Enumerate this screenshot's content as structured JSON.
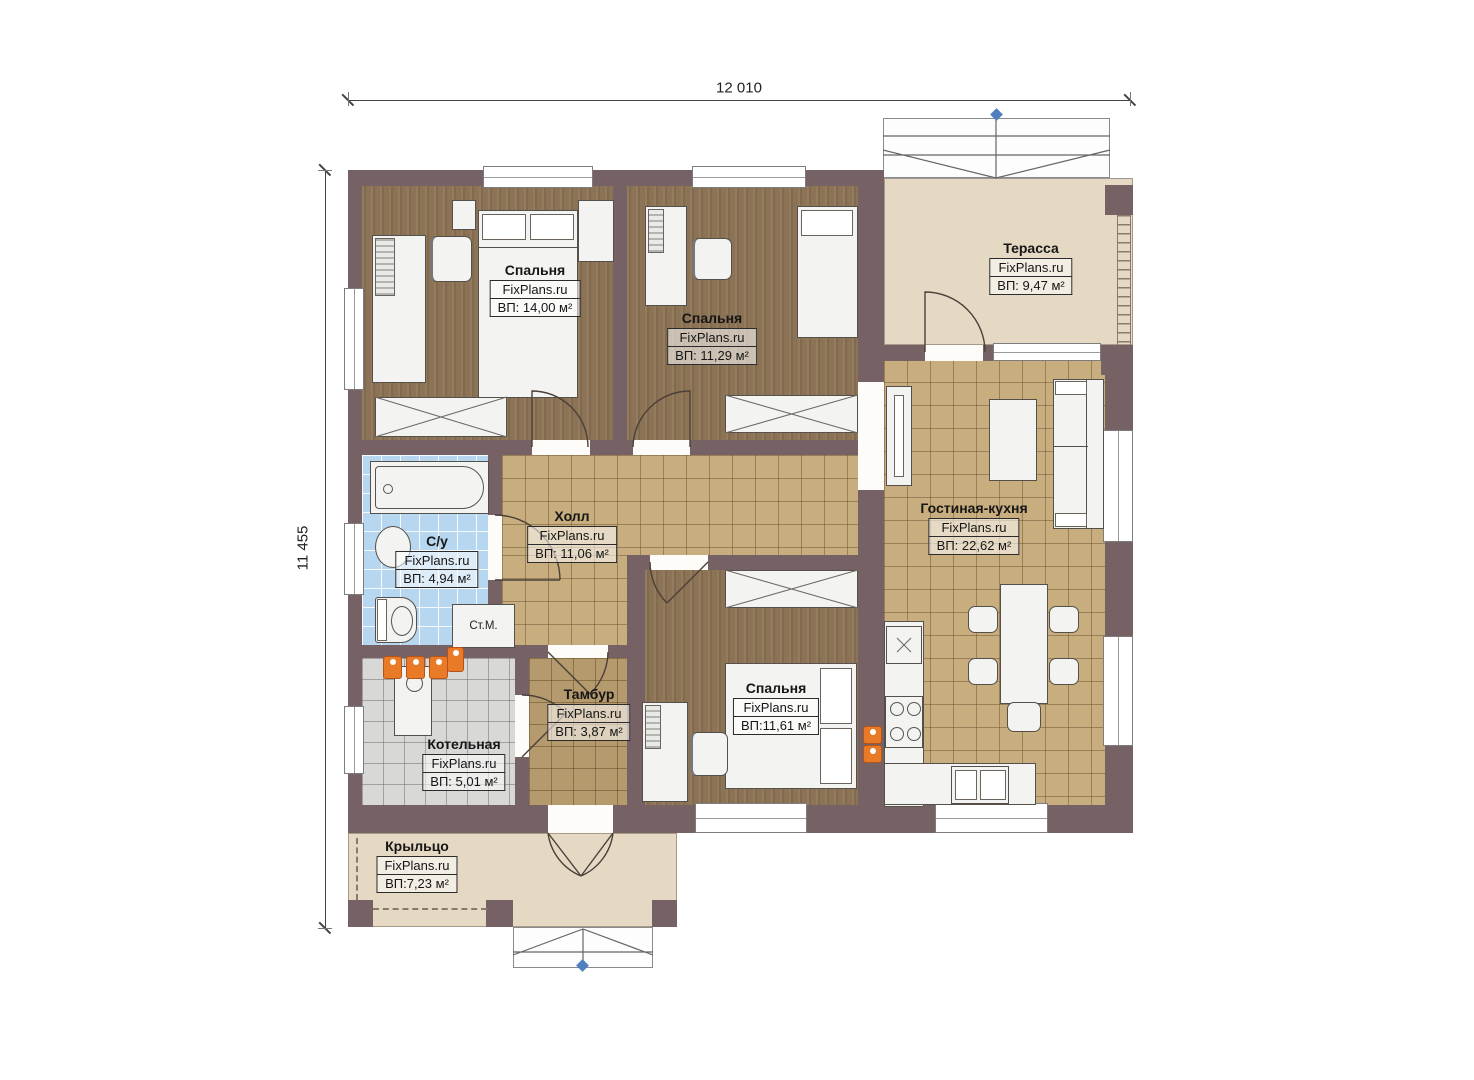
{
  "dimensions": {
    "top": "12 010",
    "left": "11 455"
  },
  "brand": "FixPlans.ru",
  "rooms": [
    {
      "id": "bedroom-1",
      "name": "Спальня",
      "area": "ВП: 14,00 м²"
    },
    {
      "id": "bedroom-2",
      "name": "Спальня",
      "area": "ВП: 11,29 м²"
    },
    {
      "id": "terrace",
      "name": "Терасса",
      "area": "ВП: 9,47 м²"
    },
    {
      "id": "hall",
      "name": "Холл",
      "area": "ВП: 11,06 м²"
    },
    {
      "id": "bathroom",
      "name": "С/у",
      "area": "ВП: 4,94 м²"
    },
    {
      "id": "living-kitchen",
      "name": "Гостиная-кухня",
      "area": "ВП: 22,62 м²"
    },
    {
      "id": "tambour",
      "name": "Тамбур",
      "area": "ВП: 3,87 м²"
    },
    {
      "id": "boiler-room",
      "name": "Котельная",
      "area": "ВП: 5,01 м²"
    },
    {
      "id": "bedroom-3",
      "name": "Спальня",
      "area": "ВП:11,61 м²"
    },
    {
      "id": "porch",
      "name": "Крыльцо",
      "area": "ВП:7,23 м²"
    }
  ],
  "annotations": {
    "washing_machine": "Ст.М."
  },
  "colors": {
    "wall": "#766264",
    "bedroom_floor": "#8c7355",
    "tile_floor": "#c8ae7f",
    "tambour_floor": "#b59a6e",
    "bath_floor": "#b7d6ef",
    "boiler_floor": "#d8d8d6",
    "outdoor_floor": "#e5d9c4",
    "radiator": "#e87a28",
    "marker_blue": "#4f7fbe"
  }
}
